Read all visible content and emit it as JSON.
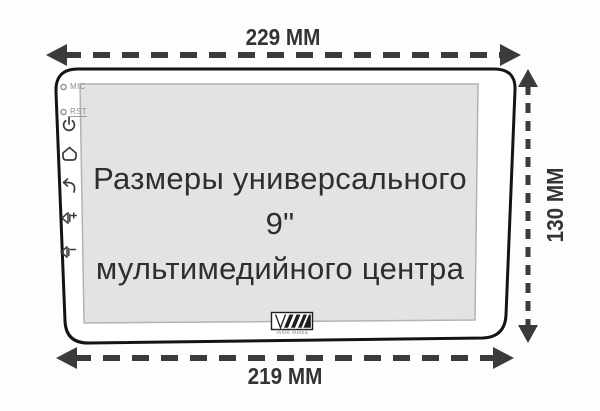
{
  "page": {
    "background": "#fdfdfd"
  },
  "dimensions": {
    "top_width_label": "229 MM",
    "bottom_width_label": "219 MM",
    "side_height_label": "130 MM"
  },
  "device": {
    "screen_title_line1": "Размеры универсального 9\"",
    "screen_title_line2": "мультимедийного центра",
    "side_panel": {
      "mic_label": "MIC",
      "rst_label": "RST",
      "icons": [
        "power-icon",
        "home-icon",
        "back-icon",
        "volume-up-icon",
        "volume-down-icon"
      ]
    },
    "logo_caption": "Wide Media"
  },
  "colors": {
    "arrow": "#3b3b3b",
    "label_text": "#333333",
    "device_outline": "#141414",
    "screen_background": "#e3e3e3",
    "screen_border": "#b3b3b3",
    "title_text": "#2e2e2e",
    "icon": "#3d3d3d",
    "muted_label": "#8f8f8f"
  }
}
